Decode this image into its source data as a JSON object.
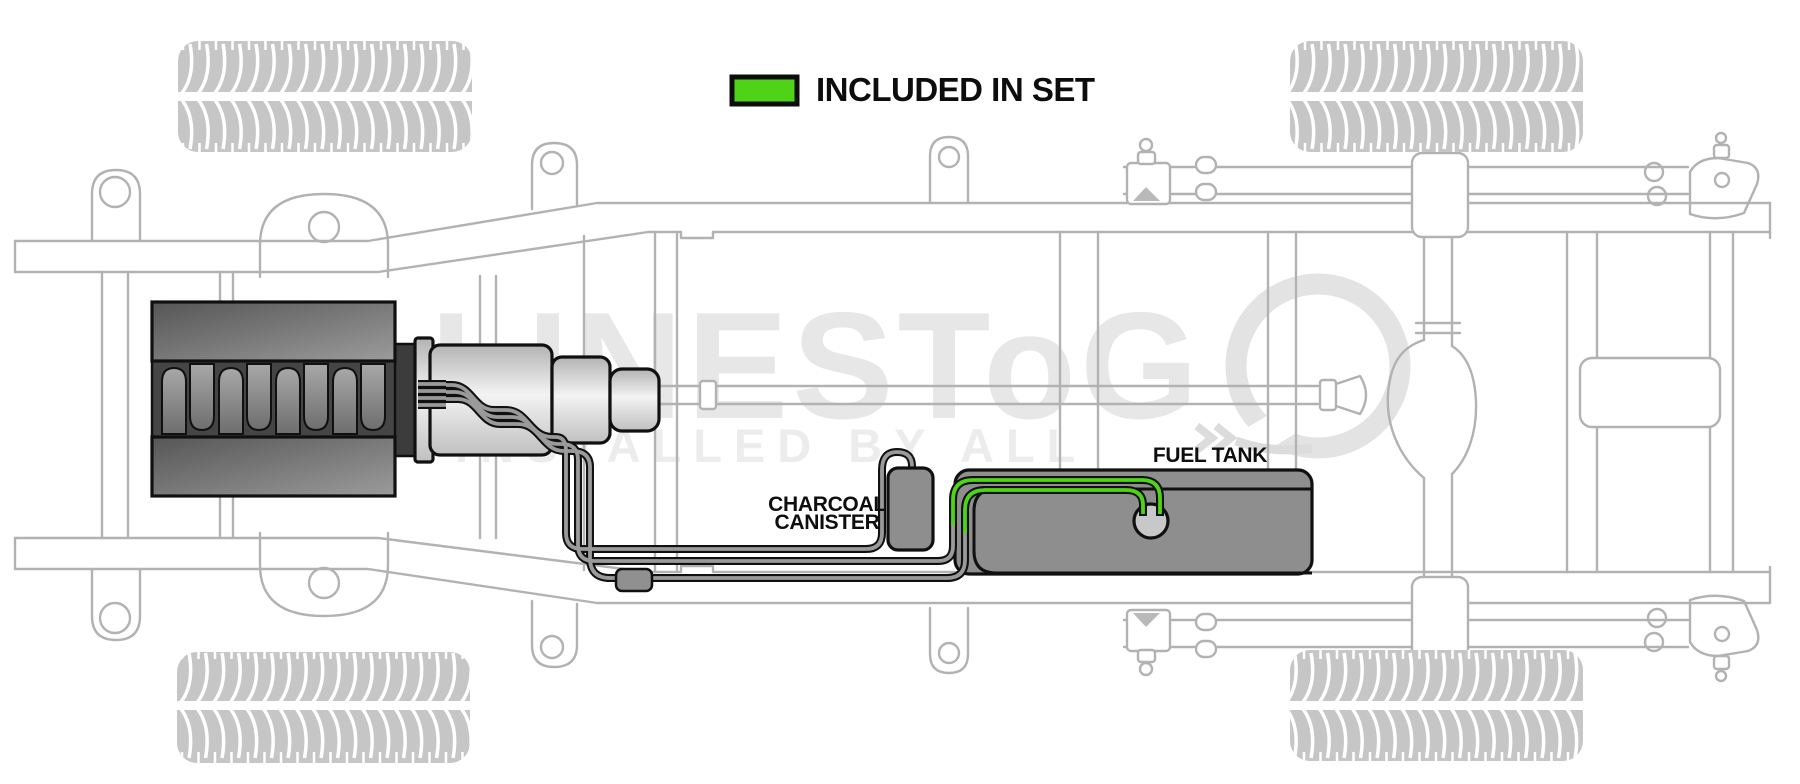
{
  "legend": {
    "label": "INCLUDED IN SET",
    "swatch_color": "#4ed316"
  },
  "labels": {
    "charcoal_canister_line1": "CHARCOAL",
    "charcoal_canister_line2": "CANISTER",
    "fuel_tank": "FUEL TANK"
  },
  "watermark": {
    "brand": "LINESToG",
    "tagline": "INSTALLED BY ALL"
  },
  "colors": {
    "included_green": "#4ed316",
    "tank_gray": "#8e8e8e",
    "tube_gray": "#9a9a9a",
    "frame_line_gray": "#b2b2b2",
    "watermark_gray": "#e7e7e7",
    "tire_gray": "#c6c6c6",
    "engine_dark": "#454545"
  }
}
